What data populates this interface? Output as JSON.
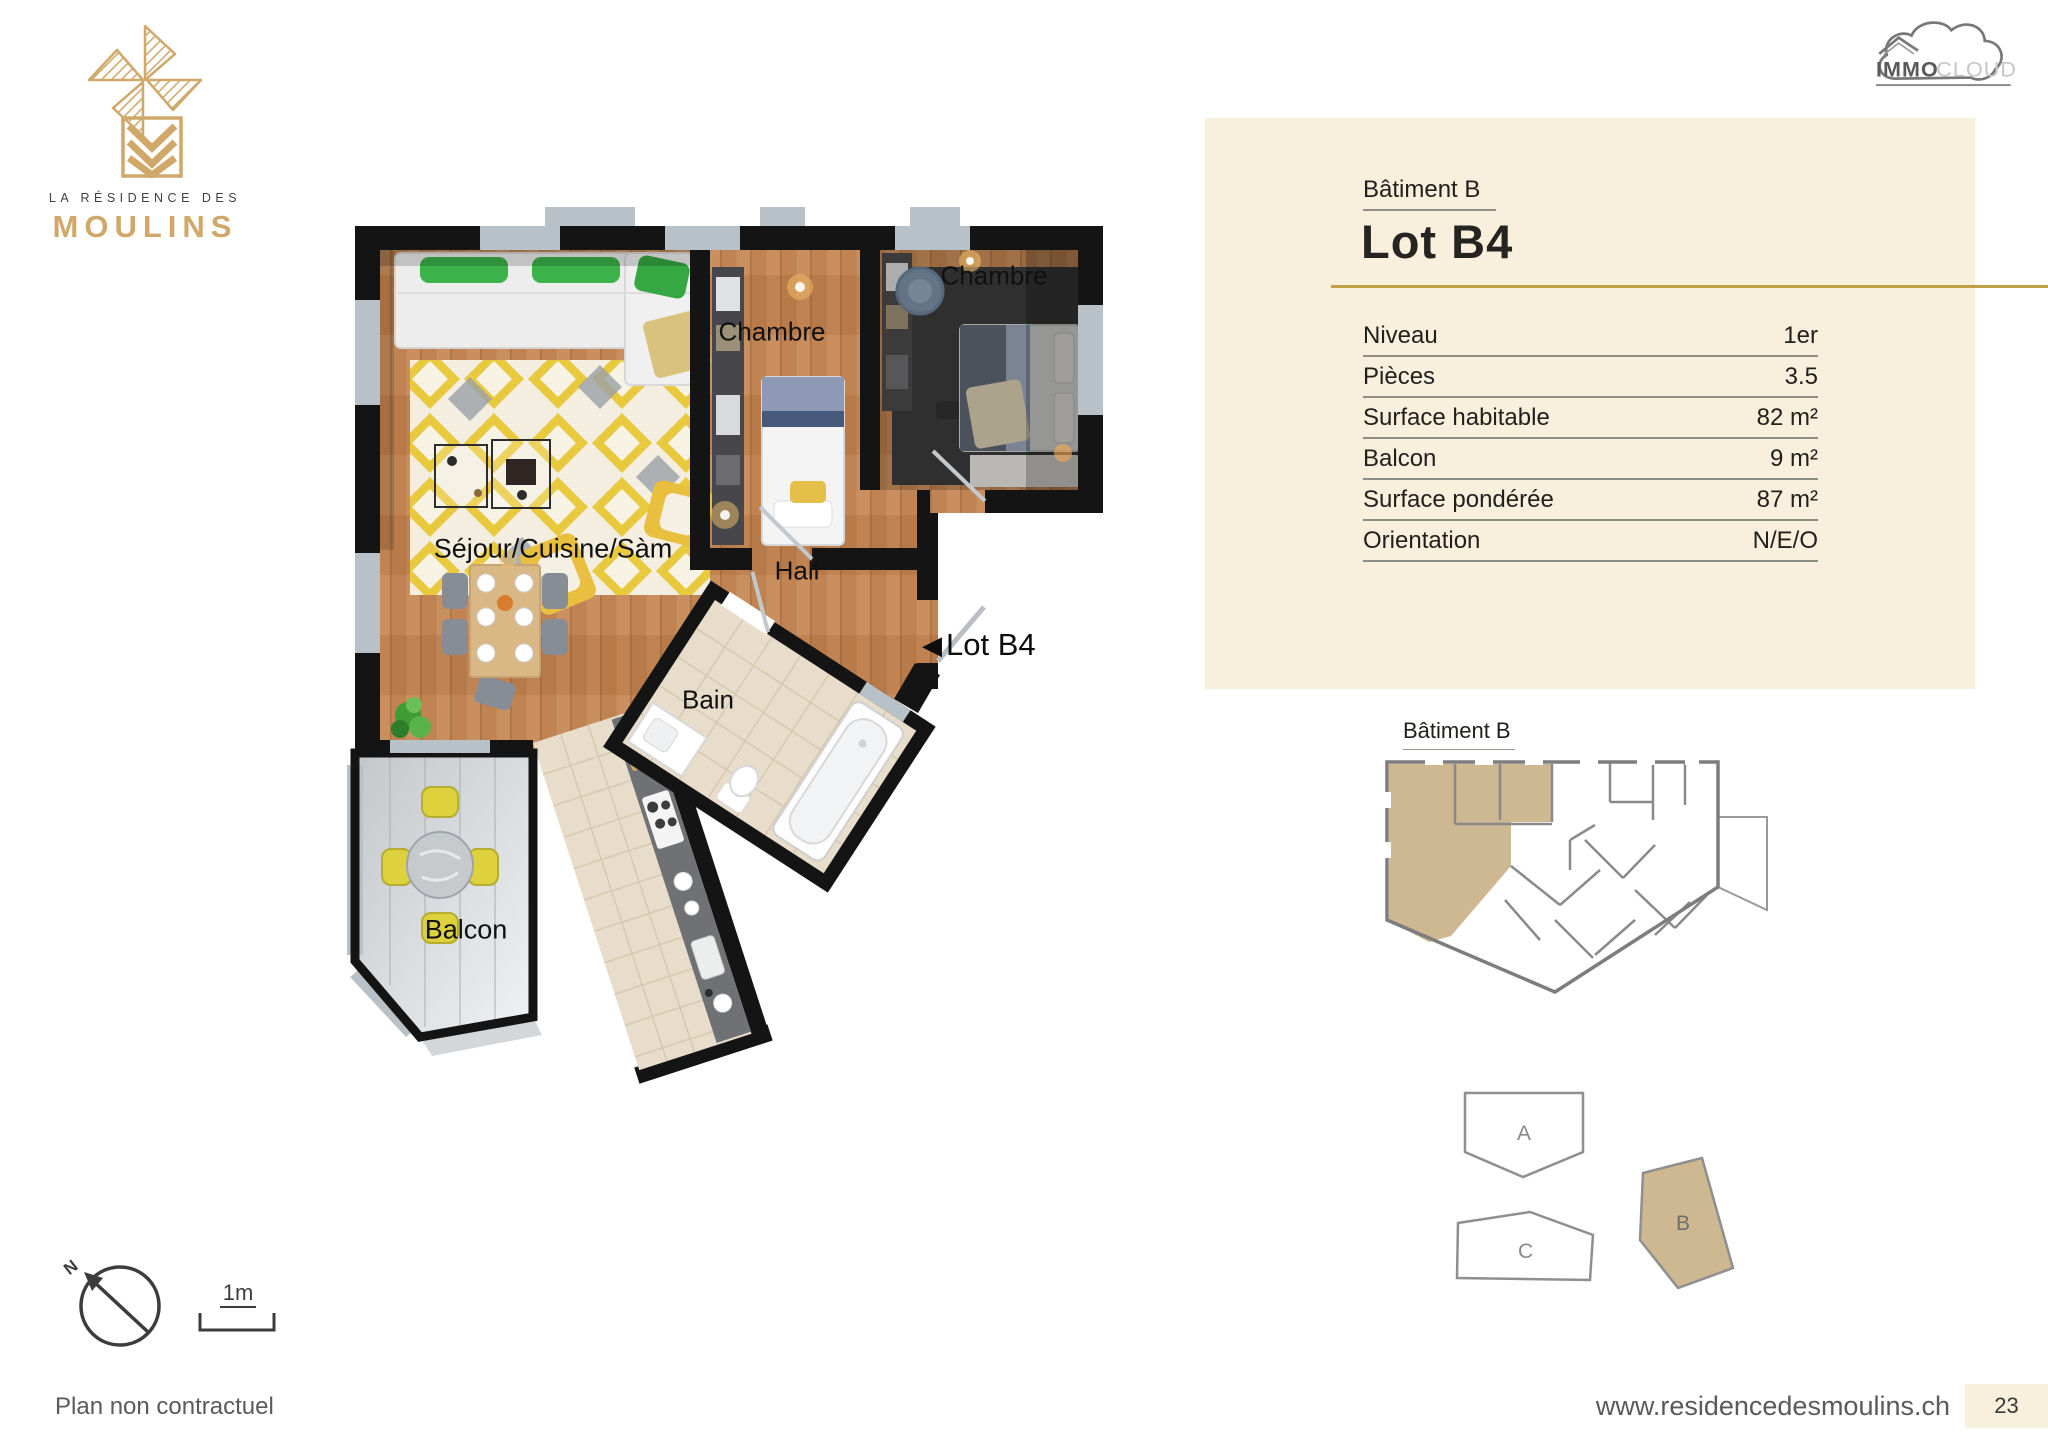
{
  "brand": {
    "line1": "LA RÉSIDENCE DES",
    "line2": "MOULINS"
  },
  "partner": {
    "bold": "IMMO",
    "light": "CLOUD"
  },
  "plan": {
    "rooms": {
      "chambre1": "Chambre",
      "chambre2": "Chambre",
      "sejour": "Séjour/Cuisine/Sàm",
      "hall": "Hall",
      "bain": "Bain",
      "balcon": "Balcon"
    },
    "lot_marker": "Lot B4",
    "marker_arrow": "◀"
  },
  "info_panel": {
    "building": "Bâtiment B",
    "lot": "Lot B4",
    "rows": [
      {
        "label": "Niveau",
        "value": "1er"
      },
      {
        "label": "Pièces",
        "value": "3.5"
      },
      {
        "label": "Surface habitable",
        "value": "82 m²"
      },
      {
        "label": "Balcon",
        "value": "9 m²"
      },
      {
        "label": "Surface pondérée",
        "value": "87 m²"
      },
      {
        "label": "Orientation",
        "value": "N/E/O"
      }
    ]
  },
  "mini_plan": {
    "title": "Bâtiment B"
  },
  "site_plan": {
    "building_a": "A",
    "building_b": "B",
    "building_c": "C"
  },
  "compass": {
    "north": "N"
  },
  "scale_bar": {
    "label": "1m"
  },
  "footer": {
    "disclaimer": "Plan non contractuel",
    "website": "www.residencedesmoulins.ch",
    "page": "23"
  },
  "colors": {
    "accent_gold": "#bfa045",
    "brand_gold": "#cfa86a",
    "panel_bg": "#f8f0dc",
    "highlight_tan": "#cdb892",
    "wall_black": "#141414"
  }
}
